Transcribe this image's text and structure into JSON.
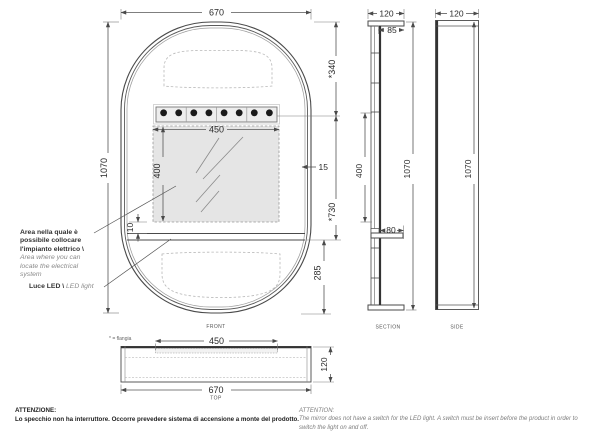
{
  "front": {
    "label": "FRONT",
    "width": "670",
    "height": "1070",
    "top_to_light": "*340",
    "light_width": "450",
    "area_height": "400",
    "edge": "15",
    "light_to_shelf": "*730",
    "area_to_shelf": "10",
    "shelf_to_bottom": "285"
  },
  "section": {
    "label": "SECTION",
    "depth": "120",
    "inner_depth": "85",
    "span": "400",
    "shelf": "80",
    "height": "1070"
  },
  "side": {
    "label": "SIDE",
    "depth": "120",
    "height": "1070"
  },
  "top": {
    "label": "TOP",
    "flange": "450",
    "width": "670",
    "depth": "120",
    "footnote": "* = flangia"
  },
  "annotations": {
    "area_it": "Area nella quale è possibile collocare l'impianto elettrico \\ ",
    "area_en": "Area where you can locate the electrical system",
    "led_it": "Luce LED \\ ",
    "led_en": "LED light"
  },
  "notes": {
    "it_title": "ATTENZIONE:",
    "it_body": "Lo specchio non ha interruttore. Occorre prevedere sistema di accensione a monte del prodotto.",
    "en_title": "ATTENTION:",
    "en_body": "The mirror does not have a switch for the LED light. A switch must be insert before the product in order to switch the light on and off."
  },
  "colors": {
    "line": "#4a4a4a",
    "fill_area": "#e5e5e5",
    "led_dot": "#1a1a1a"
  }
}
